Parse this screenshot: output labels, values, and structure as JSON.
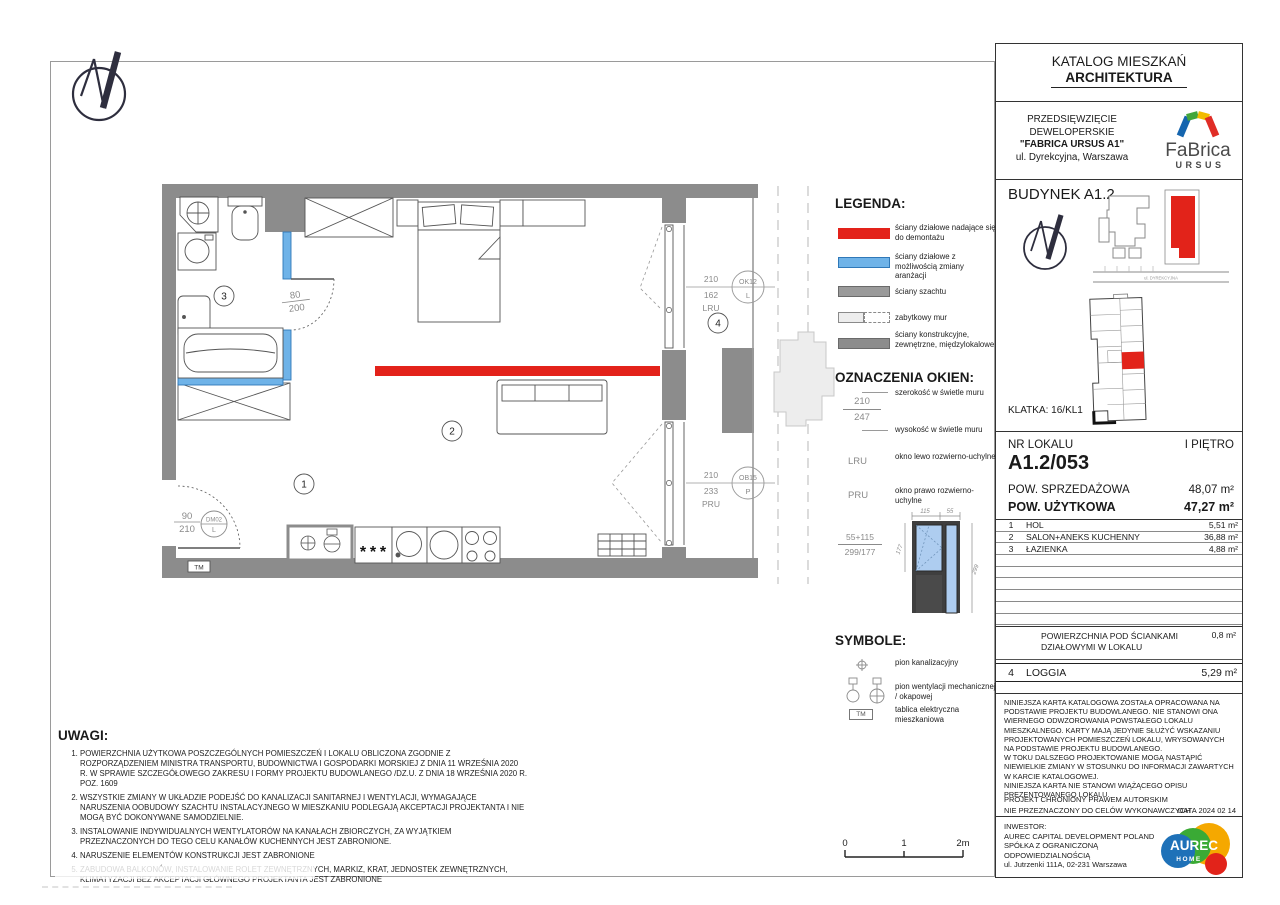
{
  "header": {
    "line1": "KATALOG MIESZKAŃ",
    "line2": "ARCHITEKTURA"
  },
  "project": {
    "line1": "PRZEDSIĘWZIĘCIE",
    "line2": "DEWELOPERSKIE",
    "line3": "\"FABRICA URSUS A1\"",
    "line4": "ul. Dyrekcyjna, Warszawa",
    "brand": "FaBrica",
    "brand_sub": "URSUS"
  },
  "building": {
    "title": "BUDYNEK A1.2",
    "klatka": "KLATKA: 16/KL1",
    "street": "ul. DYREKCYJNA"
  },
  "unit": {
    "label": "NR LOKALU",
    "floor": "I PIĘTRO",
    "number": "A1.2/053",
    "sale_label": "POW. SPRZEDAŻOWA",
    "sale_area": "48,07 m²",
    "usable_label": "POW. UŻYTKOWA",
    "usable_area": "47,27 m²"
  },
  "rooms": [
    {
      "no": "1",
      "name": "HOL",
      "area": "5,51 m²"
    },
    {
      "no": "2",
      "name": "SALON+ANEKS KUCHENNY",
      "area": "36,88 m²"
    },
    {
      "no": "3",
      "name": "ŁAZIENKA",
      "area": "4,88 m²"
    }
  ],
  "partition": {
    "label": "POWIERZCHNIA POD ŚCIANKAMI DZIAŁOWYMI W LOKALU",
    "value": "0,8 m²"
  },
  "loggia": {
    "no": "4",
    "name": "LOGGIA",
    "area": "5,29 m²"
  },
  "plan": {
    "room1": "1",
    "room2": "2",
    "room3": "3",
    "room4": "4",
    "tm": "TM",
    "bath_door": {
      "w": "80",
      "h": "200"
    },
    "entry_door": {
      "w": "90",
      "h": "210",
      "code": "DM02",
      "side": "L"
    },
    "window1": {
      "w": "210",
      "h": "162",
      "open": "LRU",
      "code": "OK12",
      "side": "L"
    },
    "window2": {
      "w": "210",
      "h": "233",
      "open": "PRU",
      "code": "OB15",
      "side": "P"
    }
  },
  "legend": {
    "title": "LEGENDA:",
    "items": [
      {
        "type": "red",
        "label": "ściany działowe nadające się do demontażu"
      },
      {
        "type": "blue",
        "label": "ściany działowe z możliwością zmiany aranżacji"
      },
      {
        "type": "shaft",
        "label": "ściany szachtu"
      },
      {
        "type": "historic",
        "label": "zabytkowy mur"
      },
      {
        "type": "structural",
        "label": "ściany konstrukcyjne, zewnętrzne, międzylokalowe"
      }
    ]
  },
  "windows_legend": {
    "title": "OZNACZENIA OKIEN:",
    "width_num": "210",
    "height_num": "247",
    "width_label": "szerokość w świetle muru",
    "height_label": "wysokość w świetle muru",
    "lru": "LRU",
    "lru_label": "okno lewo rozwierno-uchylne",
    "pru": "PRU",
    "pru_label": "okno prawo rozwierno-uchylne"
  },
  "window_detail": {
    "label_top": "55+115",
    "label_bottom": "299/177",
    "dim_top_left": "115",
    "dim_top_right": "55",
    "dim_left": "177",
    "dim_right": "299"
  },
  "symbols": {
    "title": "SYMBOLE:",
    "items": [
      {
        "icon": "sewage-riser-icon",
        "label": "pion kanalizacyjny"
      },
      {
        "icon": "ventilation-riser-icon",
        "label": "pion wentylacji mechanicznej / okapowej"
      },
      {
        "icon": "electrical-panel-icon",
        "label": "tablica elektryczna mieszkaniowa"
      }
    ]
  },
  "scalebar": {
    "t0": "0",
    "t1": "1",
    "t2": "2m"
  },
  "uwagi": {
    "title": "UWAGI:",
    "items": [
      "POWIERZCHNIA UŻYTKOWA POSZCZEGÓLNYCH POMIESZCZEŃ I LOKALU OBLICZONA ZGODNIE Z ROZPORZĄDZENIEM MINISTRA TRANSPORTU, BUDOWNICTWA I GOSPODARKI MORSKIEJ Z DNIA 11 WRZEŚNIA 2020 R. W SPRAWIE SZCZEGÓŁOWEGO ZAKRESU I FORMY PROJEKTU BUDOWLANEGO /DZ.U. Z DNIA 18 WRZEŚNIA 2020 R. POZ. 1609",
      "WSZYSTKIE ZMIANY W UKŁADZIE PODEJŚĆ DO KANALIZACJI SANITARNEJ I WENTYLACJI, WYMAGAJĄCE NARUSZENIA OOBUDOWY SZACHTU INSTALACYJNEGO W MIESZKANIU PODLEGAJĄ AKCEPTACJI PROJEKTANTA I NIE MOGĄ BYĆ DOKONYWANE SAMODZIELNIE.",
      "INSTALOWANIE INDYWIDUALNYCH WENTYLATORÓW NA KANAŁACH ZBIORCZYCH, ZA WYJĄTKIEM PRZEZNACZONYCH DO TEGO CELU KANAŁÓW KUCHENNYCH JEST ZABRONIONE.",
      "NARUSZENIE ELEMENTÓW KONSTRUKCJI JEST ZABRONIONE",
      "ZABUDOWA BALKONÓW, INSTALOWANIE ROLET ZEWNĘTRZNYCH, MARKIZ, KRAT, JEDNOSTEK ZEWNĘTRZNYCH, KLIMATYZACJI BEZ AKCEPTACJI GŁÓWNEGO PROJEKTANTA JEST ZABRONIONE"
    ]
  },
  "disclaimer": {
    "text": "NINIEJSZA KARTA KATALOGOWA ZOSTAŁA OPRACOWANA NA PODSTAWIE PROJEKTU BUDOWLANEGO. NIE STANOWI ONA WIERNEGO ODWZOROWANIA POWSTAŁEGO LOKALU MIESZKALNEGO. KARTY MAJĄ JEDYNIE SŁUŻYĆ WSKAZANIU PROJEKTOWANYCH POMIESZCZEŃ LOKALU, WRYSOWANYCH NA PODSTAWIE PROJEKTU BUDOWLANEGO.\nW TOKU DALSZEGO PROJEKTOWANIE MOGĄ NASTĄPIĆ NIEWIELKIE ZMIANY W STOSUNKU DO INFORMACJI ZAWARTYCH W KARCIE KATALOGOWEJ.\nNINIEJSZA KARTA NIE STANOWI WIĄŻĄCEGO OPISU PREZENTOWANEGO LOKALU.",
    "copyright": "PROJEKT CHRONIONY PRAWEM AUTORSKIM",
    "usage": "NIE PRZEZNACZONY DO CELÓW WYKONAWCZYCH",
    "date": "DATA 2024 02 14"
  },
  "investor": {
    "label": "INWESTOR:",
    "line1": "AUREC CAPITAL DEVELOPMENT POLAND",
    "line2": "SPÓŁKA Z OGRANICZONĄ ODPOWIEDZIALNOŚCIĄ",
    "line3": "ul. Jutrzenki 111A, 02-231 Warszawa",
    "brand": "AUREC",
    "brand_sub": "HOME"
  },
  "colors": {
    "red_wall": "#E3221A",
    "blue_wall": "#6FB3E8",
    "wall": "#8C8C8C",
    "shaft": "#9A9A9A",
    "historic": "#EDEDED"
  }
}
